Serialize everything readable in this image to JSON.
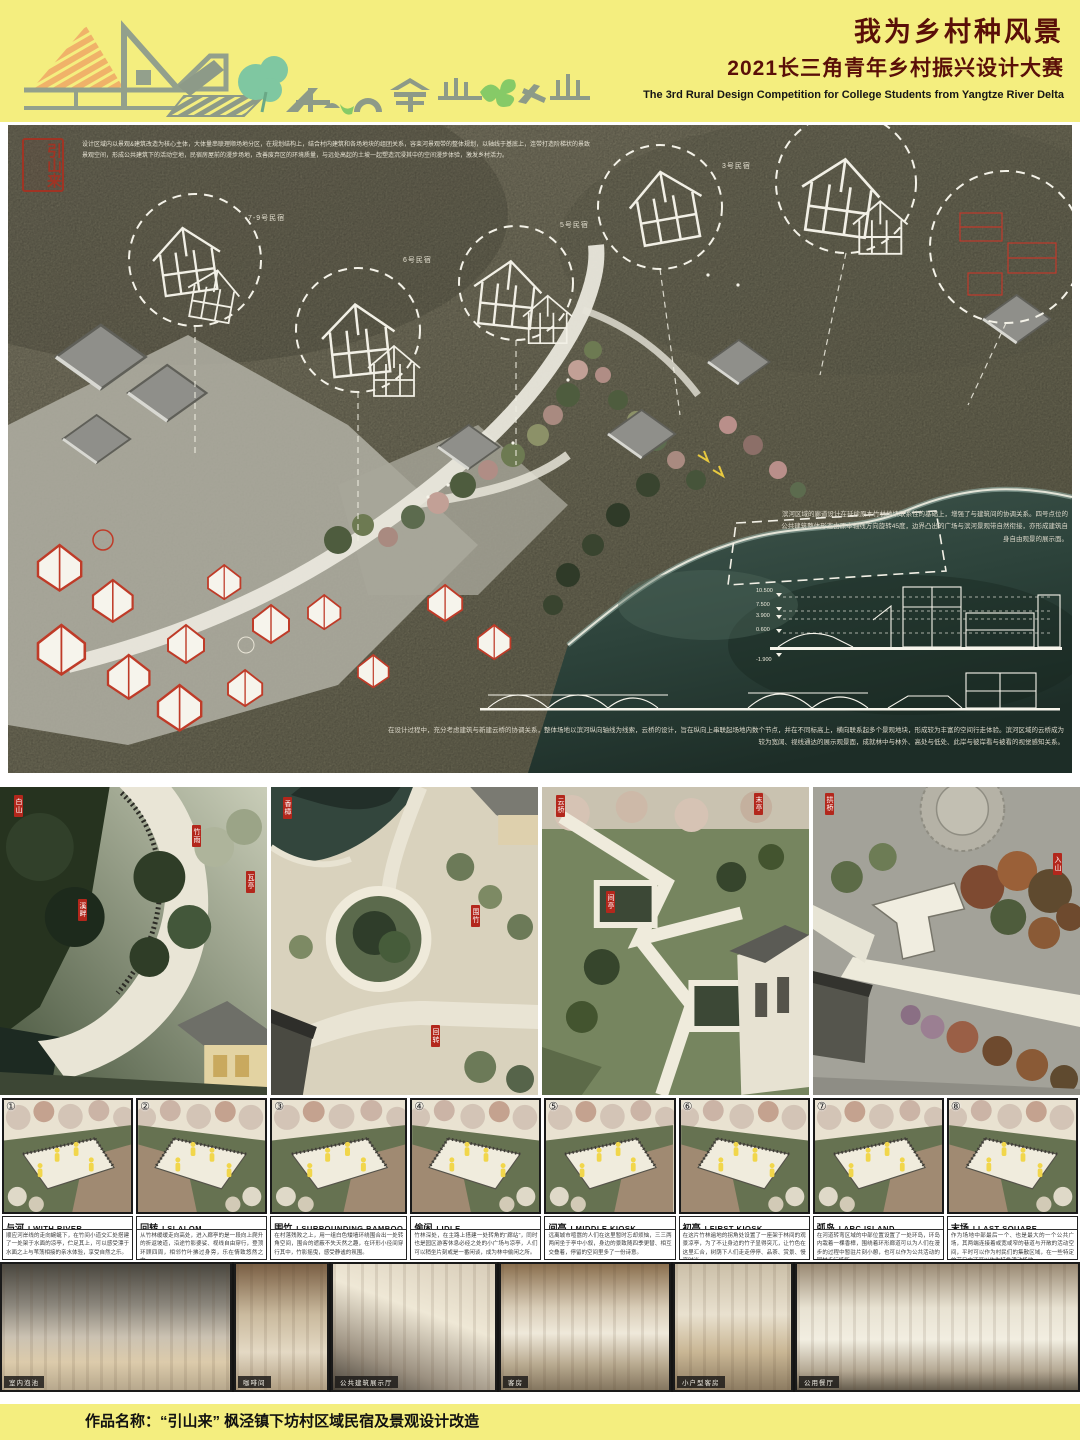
{
  "header": {
    "title_cn": "我为乡村种风景",
    "subtitle_cn": "2021长三角青年乡村振兴设计大赛",
    "subtitle_en": "The 3rd Rural Design Competition for College Students from Yangtze River Delta",
    "colors": {
      "banner_yellow": "#f4ee7f",
      "title_red": "#5a0f08",
      "logo_orange": "#f0b269",
      "logo_gray_green": "#93a08c",
      "logo_tree_green": "#7fc7a1",
      "logo_leaf_green": "#86ca67"
    }
  },
  "masterplan": {
    "seal_text": "引山来",
    "intro_text": "设计区域内以景观&建筑改造为核心主体，大体量串联理顺场地分区，在规划结构上，结合村内建筑和各场地块的组团关系，容束河景观带的整体规划，以轴线于基底上，连带打造阶梯状的景致景观空间，形成公共建筑下的活动空地，民宿房屋前的漫步场地，改善废弃区的环境质量，与远处高起的土坡一起塑造沉浸其中的空间漫步体验，激发乡村活力。",
    "river_text": "滨河区域的廊道设计在延续原本竹林地块联系性的基础上，增强了与建筑间的协调关系。四号点位的公共建筑整体形态由原本轴线方向旋转45度，边界凸出的广场与滨河景观带自然衔接，亦形成建筑自身自由观景的展示面。",
    "bridge_text": "在设计过程中，充分考虑建筑与新建云桥的协调关系，整体场地以滨河纵向轴线为线索，云桥的设计，旨在纵向上串联起场地内数个节点，并在不同标高上，横向联系起多个景观地块，形成较为丰富的空间行走体验。滨河区域的云桥成为较为宽阔、视线通达的展示观景面，成就林中与林外、高处与低处、此岸与彼岸看与被看的视觉感知关系。",
    "callouts": [
      {
        "label": "7-9号民宿"
      },
      {
        "label": "6号民宿"
      },
      {
        "label": "5号民宿"
      },
      {
        "label": "3号民宿"
      }
    ],
    "section_levels": [
      "10.500",
      "7.500",
      "3.900",
      "0.600",
      "-1.900"
    ]
  },
  "perspectives": [
    {
      "tags": [
        "白山",
        "竹雨",
        "瓦亭",
        "溪畔"
      ]
    },
    {
      "tags": [
        "香樟",
        "围竹",
        "回转"
      ]
    },
    {
      "tags": [
        "云桥",
        "末亭",
        "间亭"
      ]
    },
    {
      "tags": [
        "拱桥",
        "入山"
      ]
    }
  ],
  "diagrams": {
    "items": [
      {
        "num": "①",
        "title_cn": "与河",
        "title_en": "I WITH RIVER",
        "desc": "顺应河岸线的走向蜿蜒下，在竹间小道交汇处搭建了一处架于水面的凉亭，伫足其上，可以感受漂于水面之上与苇荡相接的亲水体验，享受自然之乐。"
      },
      {
        "num": "②",
        "title_cn": "回转",
        "title_en": "I SLALOM",
        "desc": "从竹林缓缓走向高处，进入廊亭的是一段向上爬升的折返坡道，沿途竹影婆娑、视线自由穿行，登顶环顾四周，相邻竹叶拂过身旁，乐在情致悠然之中。"
      },
      {
        "num": "③",
        "title_cn": "围竹",
        "title_en": "I SURROUNDING BAMBOO",
        "desc": "在村落残败之上，用一组白色矮墙环绕围合出一处转角空间，围合的遮蔽不失天然之趣，在环形小径间穿行其中，竹影摇曳，感受静谧的氛围。"
      },
      {
        "num": "④",
        "title_cn": "偷闲",
        "title_en": "I IDLE",
        "desc": "竹林深处，在主路上搭建一处转角的“廊站”，同时也是园区游客休息必经之处的小广场与凉亭，人们可以稍坐片刻或是一番闲谈，成为林中偷闲之所。"
      },
      {
        "num": "⑤",
        "title_cn": "间亭",
        "title_en": "I MIDDLE KIOSK",
        "desc": "远离城市喧嚣的人们在这里暂时忘却烦恼，三三两两闲坐于亭中小叙，身边的景致随四季更替、相互交叠着，停留的空间里多了一份诗意。"
      },
      {
        "num": "⑥",
        "title_cn": "初亭",
        "title_en": "I FIRST KIOSK",
        "desc": "在这片竹林遍地的拐角处设置了一座架于林间的观景凉亭，为了不让身边的竹子显得突兀，让竹色在这里汇合，树荫下人们走走停停、品茶、赏景、慢享时光。"
      },
      {
        "num": "⑦",
        "title_cn": "弧岛",
        "title_en": "I ARC ISLAND",
        "desc": "在河道转弯区域的中部位置设置了一处环岛，环岛内栽着一棵香樟，围绕着环形廊道可以为人们在漫步的过程中暂驻片刻小憩，也可以作为公共活动的园林步行场所。"
      },
      {
        "num": "⑧",
        "title_cn": "末场",
        "title_en": "I LAST SQUARE",
        "desc": "作为场地中部最后一个、也是最大的一个公共广场，其两端连接着或宽或窄的巷道与开敞的活动空间，平时可以作为村民们的集散区域，在一些特定的节日中还可以作为特色活动场地。"
      }
    ]
  },
  "photos": {
    "items": [
      {
        "caption": "室内泡池"
      },
      {
        "caption": "咖啡间"
      },
      {
        "caption": "公共建筑展示厅"
      },
      {
        "caption": "客房"
      },
      {
        "caption": "小户型客房"
      },
      {
        "caption": "公用餐厅"
      }
    ]
  },
  "footer": {
    "text": "作品名称：“引山来”  枫泾镇下坊村区域民宿及景观设计改造"
  }
}
